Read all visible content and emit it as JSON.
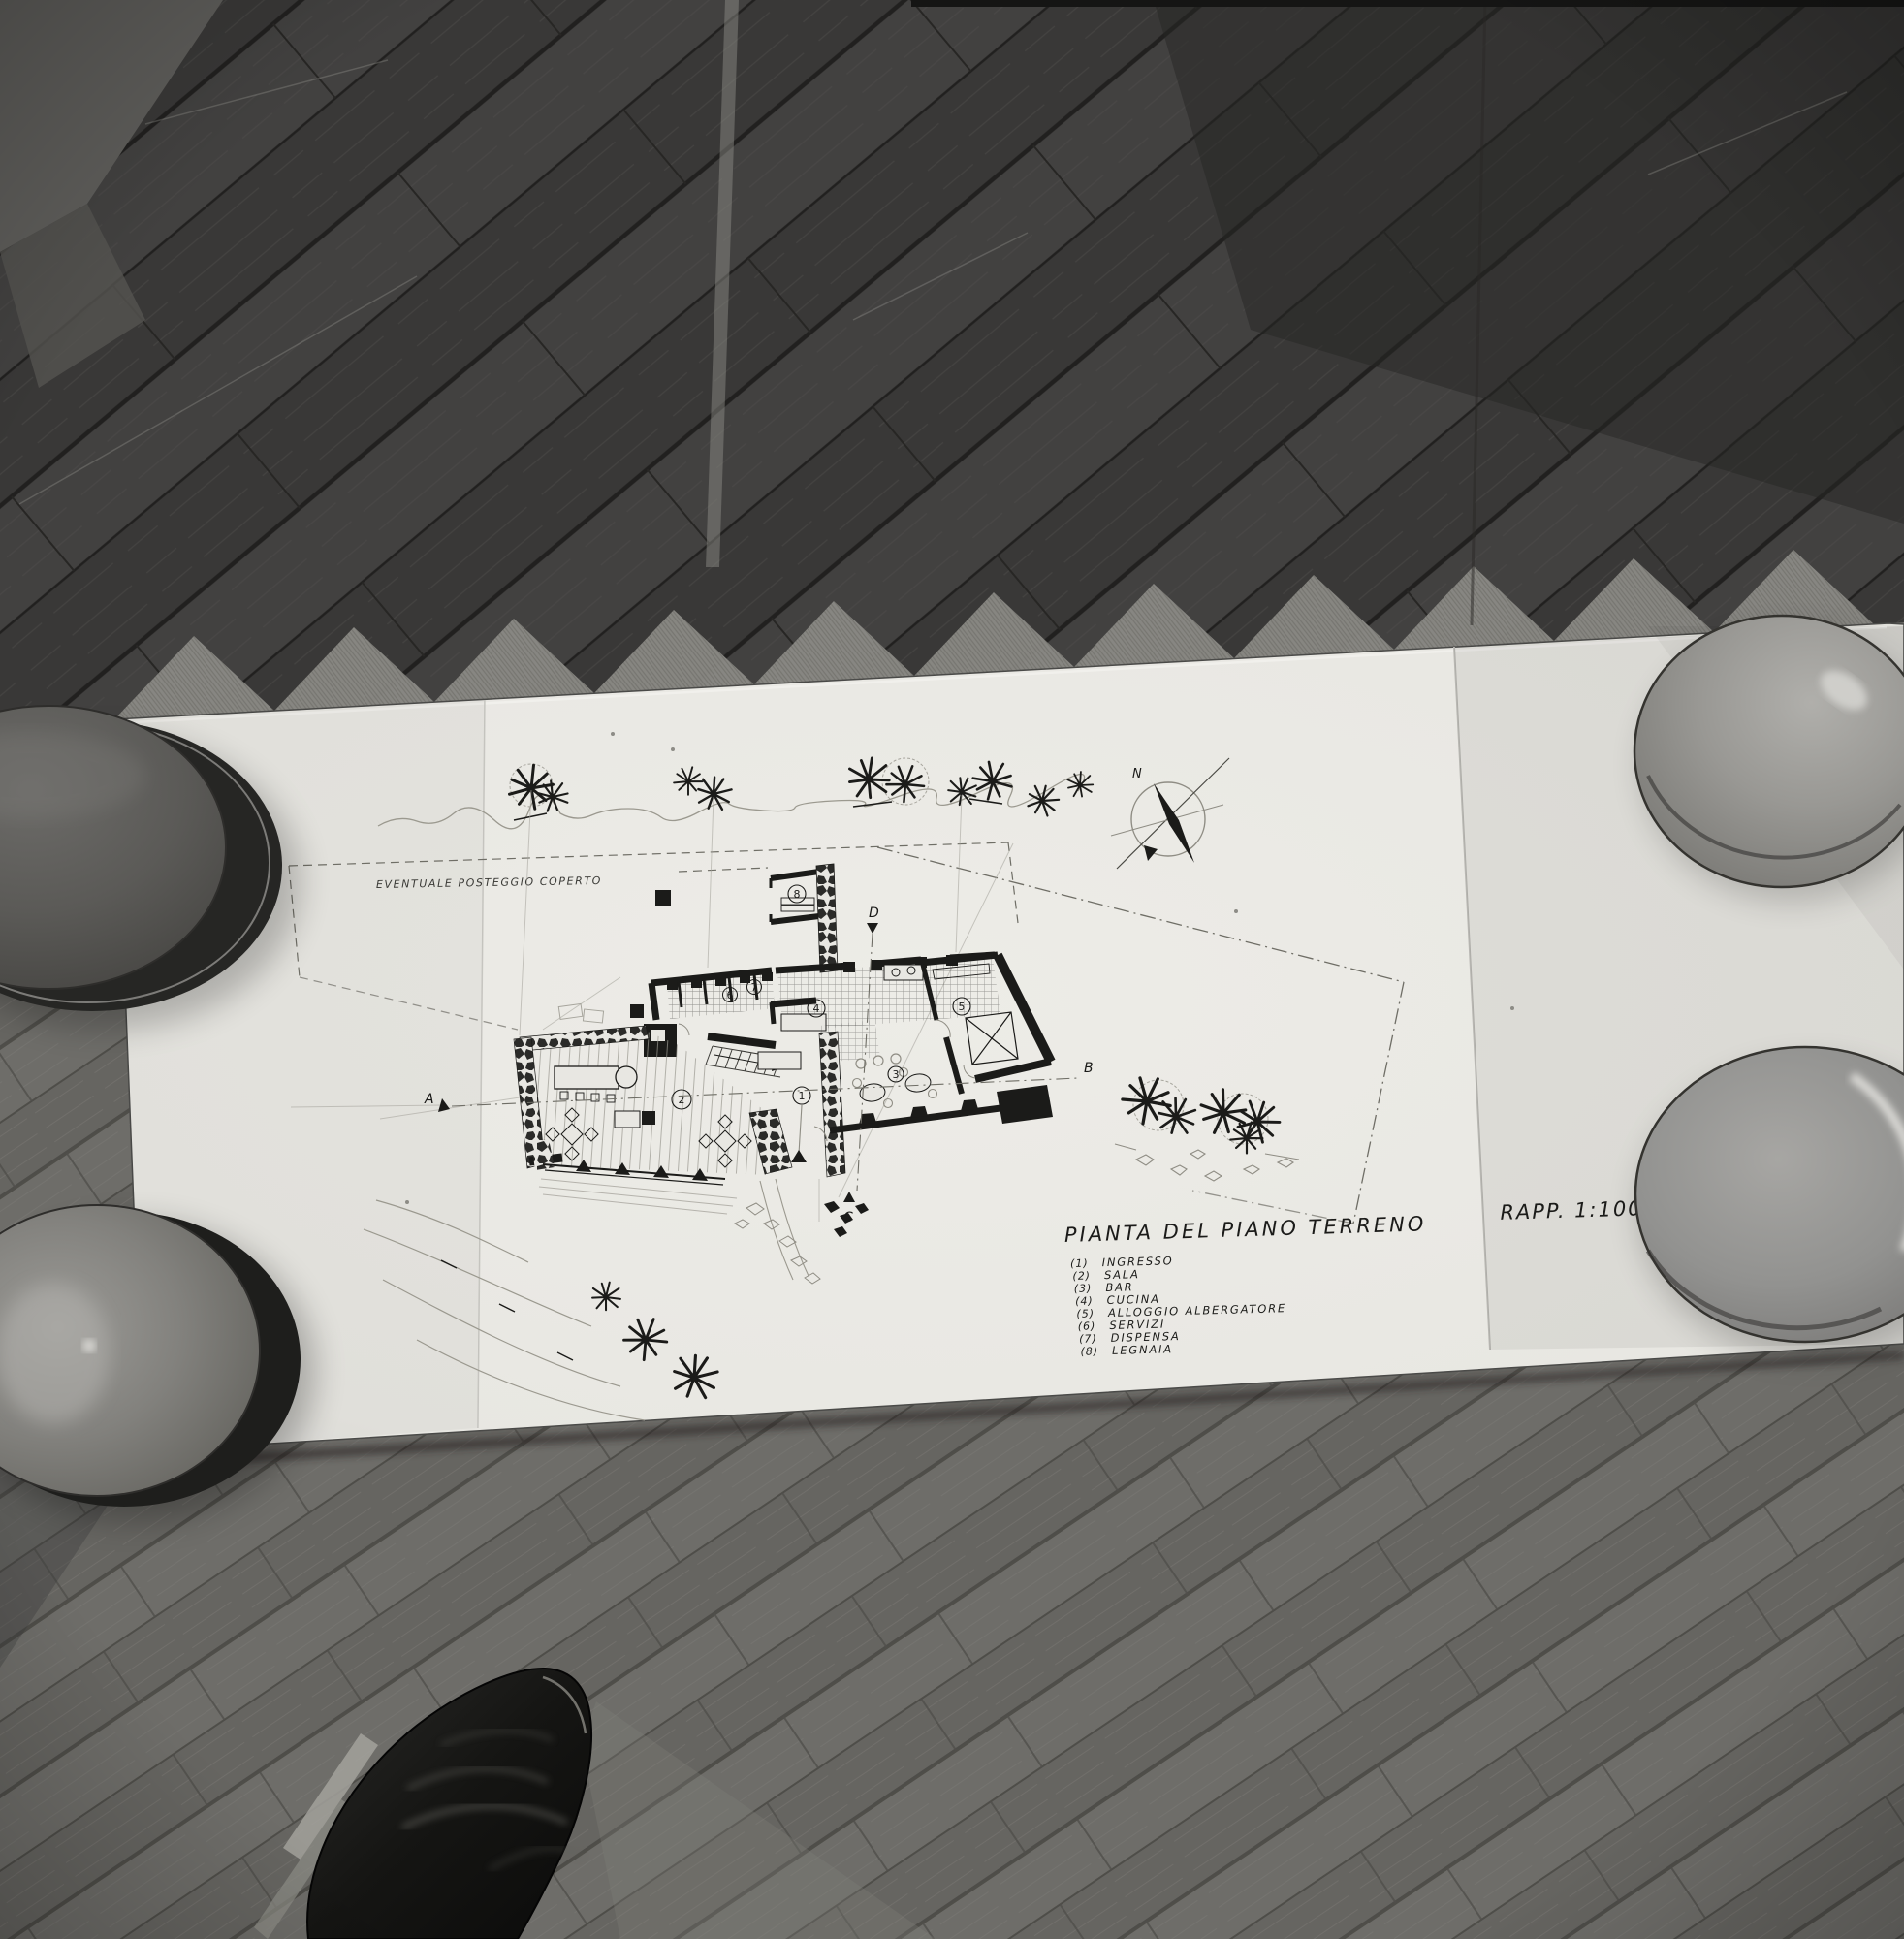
{
  "drawing": {
    "title": "PIANTA DEL PIANO TERRENO",
    "scale_note": "RAPP. 1:100",
    "site_note": "EVENTUALE POSTEGGIO COPERTO",
    "compass_north": "N",
    "rooms": {
      "r1": "1",
      "r2": "2",
      "r3": "3",
      "r4": "4",
      "r5": "5",
      "r6": "6",
      "r7": "7",
      "r8": "8"
    },
    "markers": {
      "a": "A",
      "b": "B",
      "c": "C",
      "d": "D"
    },
    "legend": [
      {
        "n": "(1)",
        "label": "INGRESSO"
      },
      {
        "n": "(2)",
        "label": "SALA"
      },
      {
        "n": "(3)",
        "label": "BAR"
      },
      {
        "n": "(4)",
        "label": "CUCINA"
      },
      {
        "n": "(5)",
        "label": "ALLOGGIO ALBERGATORE"
      },
      {
        "n": "(6)",
        "label": "SERVIZI"
      },
      {
        "n": "(7)",
        "label": "DISPENSA"
      },
      {
        "n": "(8)",
        "label": "LEGNAIA"
      }
    ],
    "colors": {
      "paper": "#e8e7e2",
      "ink": "#1b1b19",
      "pencil": "#9b998f",
      "floor_dark": "#3d3c3a",
      "floor_mid": "#6a6965",
      "bowl_grey": "#8a8986",
      "shoe_black": "#121210"
    }
  }
}
